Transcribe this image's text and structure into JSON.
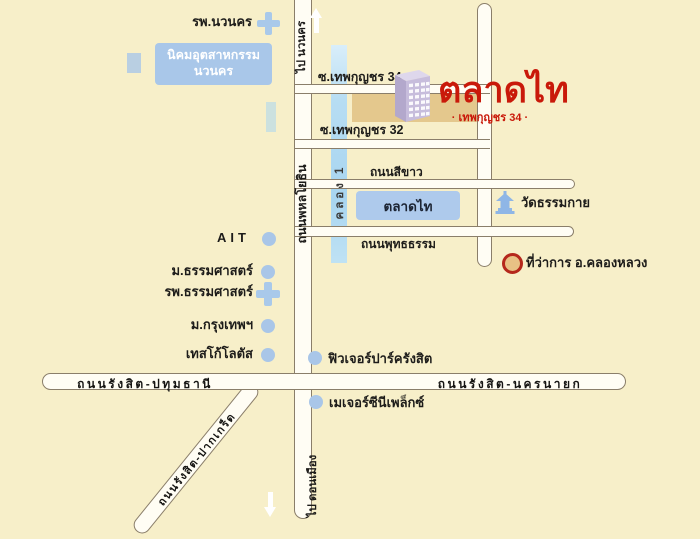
{
  "map": {
    "title": "ตลาดไท",
    "subtitle": "· เทพกุญชร 34 ·",
    "colors": {
      "land": "#f7efc9",
      "title_red": "#c9190a",
      "marker_blue": "#a9c6e8",
      "canal_blue": "#a8d5f0",
      "highlight_tan": "#e4c88d",
      "road_fill": "#fffdf4",
      "road_outline": "#8a7e6a",
      "district_ring_red": "#b5281c"
    },
    "roads": {
      "phahonyothin": "ถนนพหลโยธิน",
      "to_navanakorn": "ไป นวนคร",
      "to_donmueang": "ไป ดอนเมือง",
      "khlong1": "คลอง 1",
      "soi34": "ซ.เทพกุญชร 34",
      "soi32": "ซ.เทพกุญชร 32",
      "sikhao": "ถนนสีขาว",
      "phuttatham": "ถนนพุทธธรรม",
      "rangsit_pathumthani": "ถนนรังสิต-ปทุมธานี",
      "rangsit_nakhonnayok": "ถนนรังสิต-นครนายก",
      "rangsit_pakkret": "ถนนรังสิต-ปากเกร็ด"
    },
    "places": {
      "navanakorn_hospital": "รพ.นวนคร",
      "navanakorn_estate_line1": "นิคมอุตสาหกรรม",
      "navanakorn_estate_line2": "นวนคร",
      "talaadthai": "ตลาดไท",
      "wat_dhammakaya": "วัดธรรมกาย",
      "district_office": "ที่ว่าการ อ.คลองหลวง",
      "ait": "AIT",
      "thammasat_university": "ม.ธรรมศาสตร์",
      "thammasat_hospital": "รพ.ธรรมศาสตร์",
      "bangkok_university": "ม.กรุงเทพฯ",
      "tesco_lotus": "เทสโก้โลตัส",
      "future_park": "ฟิวเจอร์ปาร์ครังสิต",
      "major_cineplex": "เมเจอร์ซีนีเพล็กซ์"
    }
  }
}
